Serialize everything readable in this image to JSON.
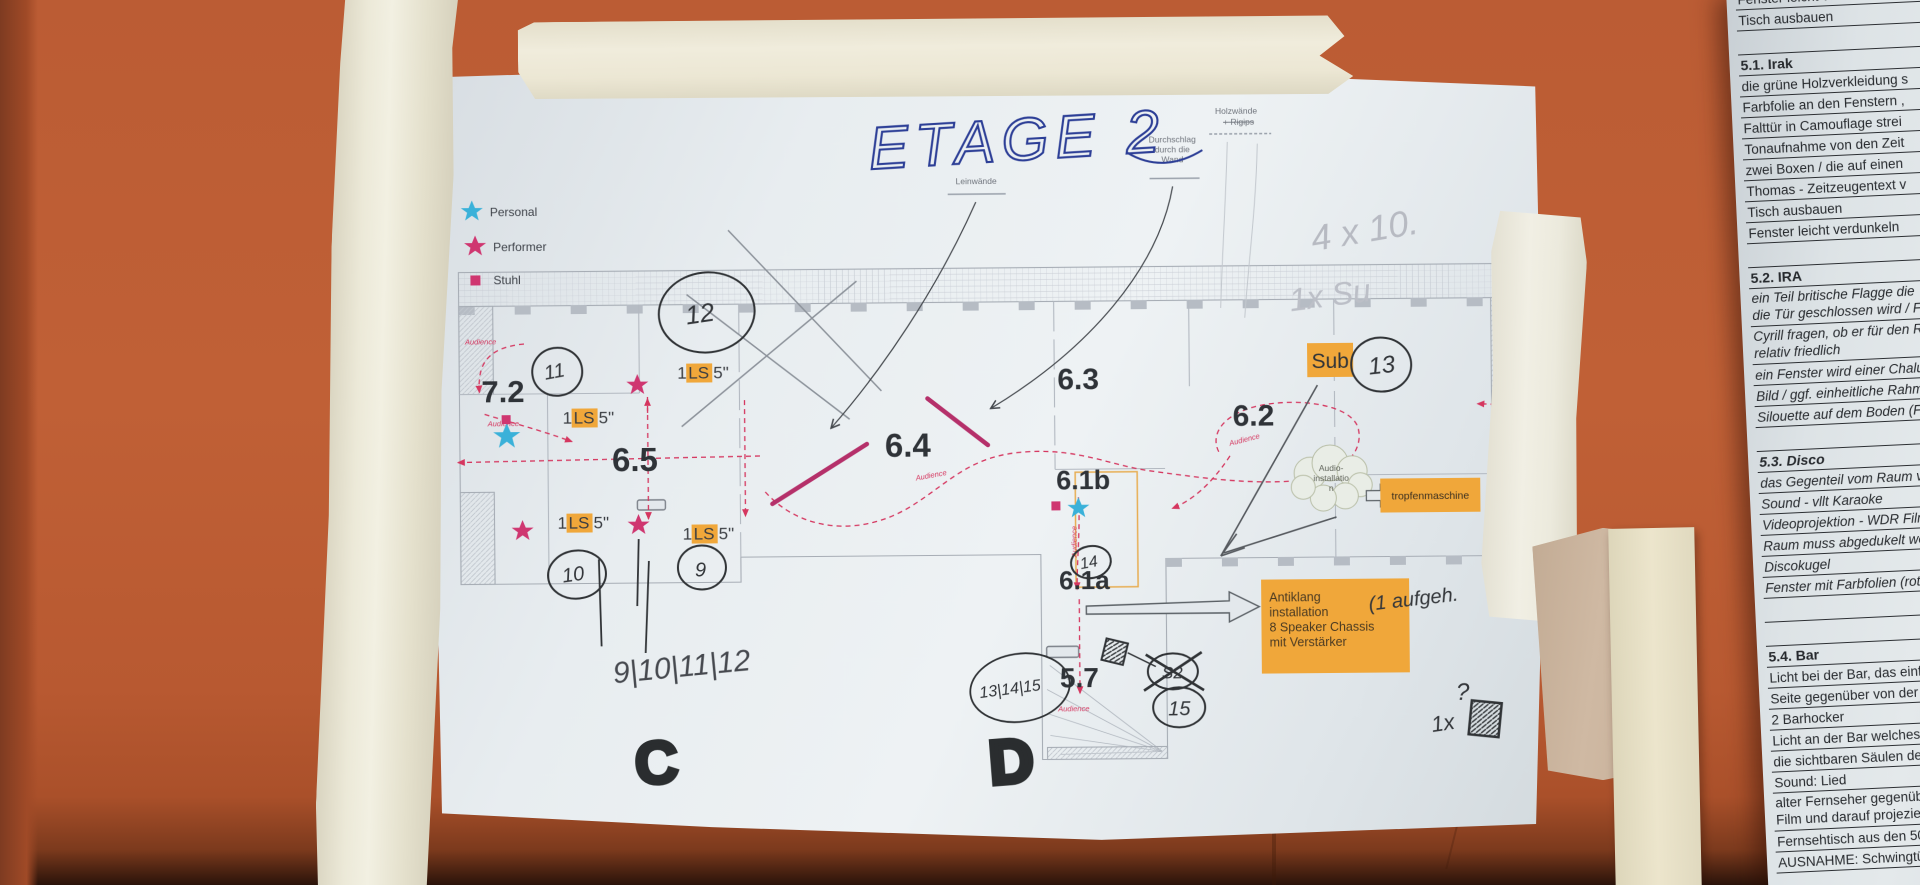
{
  "colors": {
    "wall": "#bb5c34",
    "paper": "#e8edf0",
    "tape_cream": "#ece9d8",
    "tape_tan": "#cfb9a3",
    "highlight_orange": "#f0a73a",
    "personal_blue": "#3ab1d9",
    "performer_pink": "#cf3670",
    "audience_red": "#d5365f",
    "blue_ink": "#2c3e96",
    "black_ink": "#303336",
    "pencil": "#b7bac2"
  },
  "title": "ETAGE 2",
  "legend": {
    "items": [
      {
        "label": "Personal"
      },
      {
        "label": "Performer"
      },
      {
        "label": "Stuhl"
      }
    ]
  },
  "plan": {
    "rooms": {
      "r72": "7.2",
      "r65": "6.5",
      "r64": "6.4",
      "r63": "6.3",
      "r62": "6.2",
      "r61b": "6.1b",
      "r61a": "6.1a",
      "r57": "5.7"
    },
    "printed": {
      "holzwaende": "Holzwände",
      "rigips": "+ Rigips",
      "durchschlag1": "Durchschlag",
      "durchschlag2": "durch die",
      "durchschlag3": "Wand",
      "leinwaende": "Leinwände",
      "audience": "Audience"
    },
    "ls": {
      "prefix": "1 ",
      "mid": "LS",
      "suffix": " 5\""
    },
    "sub": "Sub",
    "tropfenmaschine": "tropfenmaschine",
    "cloud": {
      "line1": "Audio-",
      "line2": "installatio",
      "line3": "n"
    },
    "antiklang": {
      "line1": "Antiklang",
      "line2": "installation",
      "line3": "8 Speaker Chassis",
      "line4": "mit Verstärker"
    },
    "circled": {
      "c9": "9",
      "c10": "10",
      "c11": "11",
      "c12": "12",
      "c13": "13",
      "c14": "14",
      "c15": "15",
      "cs2": "S2",
      "c131415": "13|14|15"
    },
    "hand": {
      "marker_c": "C",
      "marker_d": "D",
      "seq": "9|10|11|12",
      "note_4x10": "4 x 10.",
      "note_1xsu": "1x Su",
      "note_antiklang": "(1 aufgeh.",
      "qty_1x": "1x",
      "question": "?"
    }
  },
  "checklist": {
    "rows": [
      {
        "t": "Fenster leicht ver"
      },
      {
        "t": "Tisch ausbauen"
      },
      {
        "t": ""
      },
      {
        "t": "5.1. Irak",
        "b": true
      },
      {
        "t": "die grüne Holzverkleidung s"
      },
      {
        "t": "Farbfolie an den Fenstern ,"
      },
      {
        "t": "Falttür in Camouflage strei"
      },
      {
        "t": "Tonaufnahme von den Zeit"
      },
      {
        "t": "zwei Boxen / die auf einen"
      },
      {
        "t": "Thomas -  Zeitzeugentext v"
      },
      {
        "t": "Tisch ausbauen"
      },
      {
        "t": "Fenster leicht verdunkeln"
      },
      {
        "t": ""
      },
      {
        "t": "5.2. IRA",
        "b": true
      },
      {
        "t": "ein Teil britische Flagge die",
        "t2": "die Tür geschlossen wird / F",
        "i": true
      },
      {
        "t": "Cyrill fragen, ob er für den Ra",
        "t2": "relativ friedlich",
        "i": true
      },
      {
        "t": "ein Fenster wird einer Chalusi",
        "i": true
      },
      {
        "t": "Bild  / ggf. einheitliche Rahme",
        "i": true
      },
      {
        "t": "Silouette auf dem Boden (Farb",
        "i": true
      },
      {
        "t": ""
      },
      {
        "t": "5.3. Disco",
        "b": true,
        "i": true
      },
      {
        "t": "das Gegenteil vom Raum vorher",
        "i": true
      },
      {
        "t": "Sound - vllt Karaoke",
        "i": true
      },
      {
        "t": "Videoprojektion - WDR Film / Die",
        "i": true
      },
      {
        "t": "Raum muss abgedukelt werden",
        "i": true
      },
      {
        "t": "Discokugel",
        "i": true
      },
      {
        "t": "Fenster mit Farbfolien (rot/grün/h",
        "i": true
      },
      {
        "t": ""
      },
      {
        "t": ""
      },
      {
        "t": "5.4. Bar",
        "b": true
      },
      {
        "t": "Licht bei der Bar, das einfach ein u"
      },
      {
        "t": "Seite gegenüber von der Bar ist ko"
      },
      {
        "t": "2 Barhocker"
      },
      {
        "t": "Licht an der Bar welches an und a"
      },
      {
        "t": "die sichtbaren Säulen der ersten S"
      },
      {
        "t": "Sound: Lied"
      },
      {
        "t": "alter Fernseher gegenüber von de",
        "t2": "Film  und darauf projezieren"
      },
      {
        "t": "Fernsehtisch aus den 50er Jahren"
      },
      {
        "t": "AUSNAHME: Schwingtür und geg"
      }
    ]
  }
}
